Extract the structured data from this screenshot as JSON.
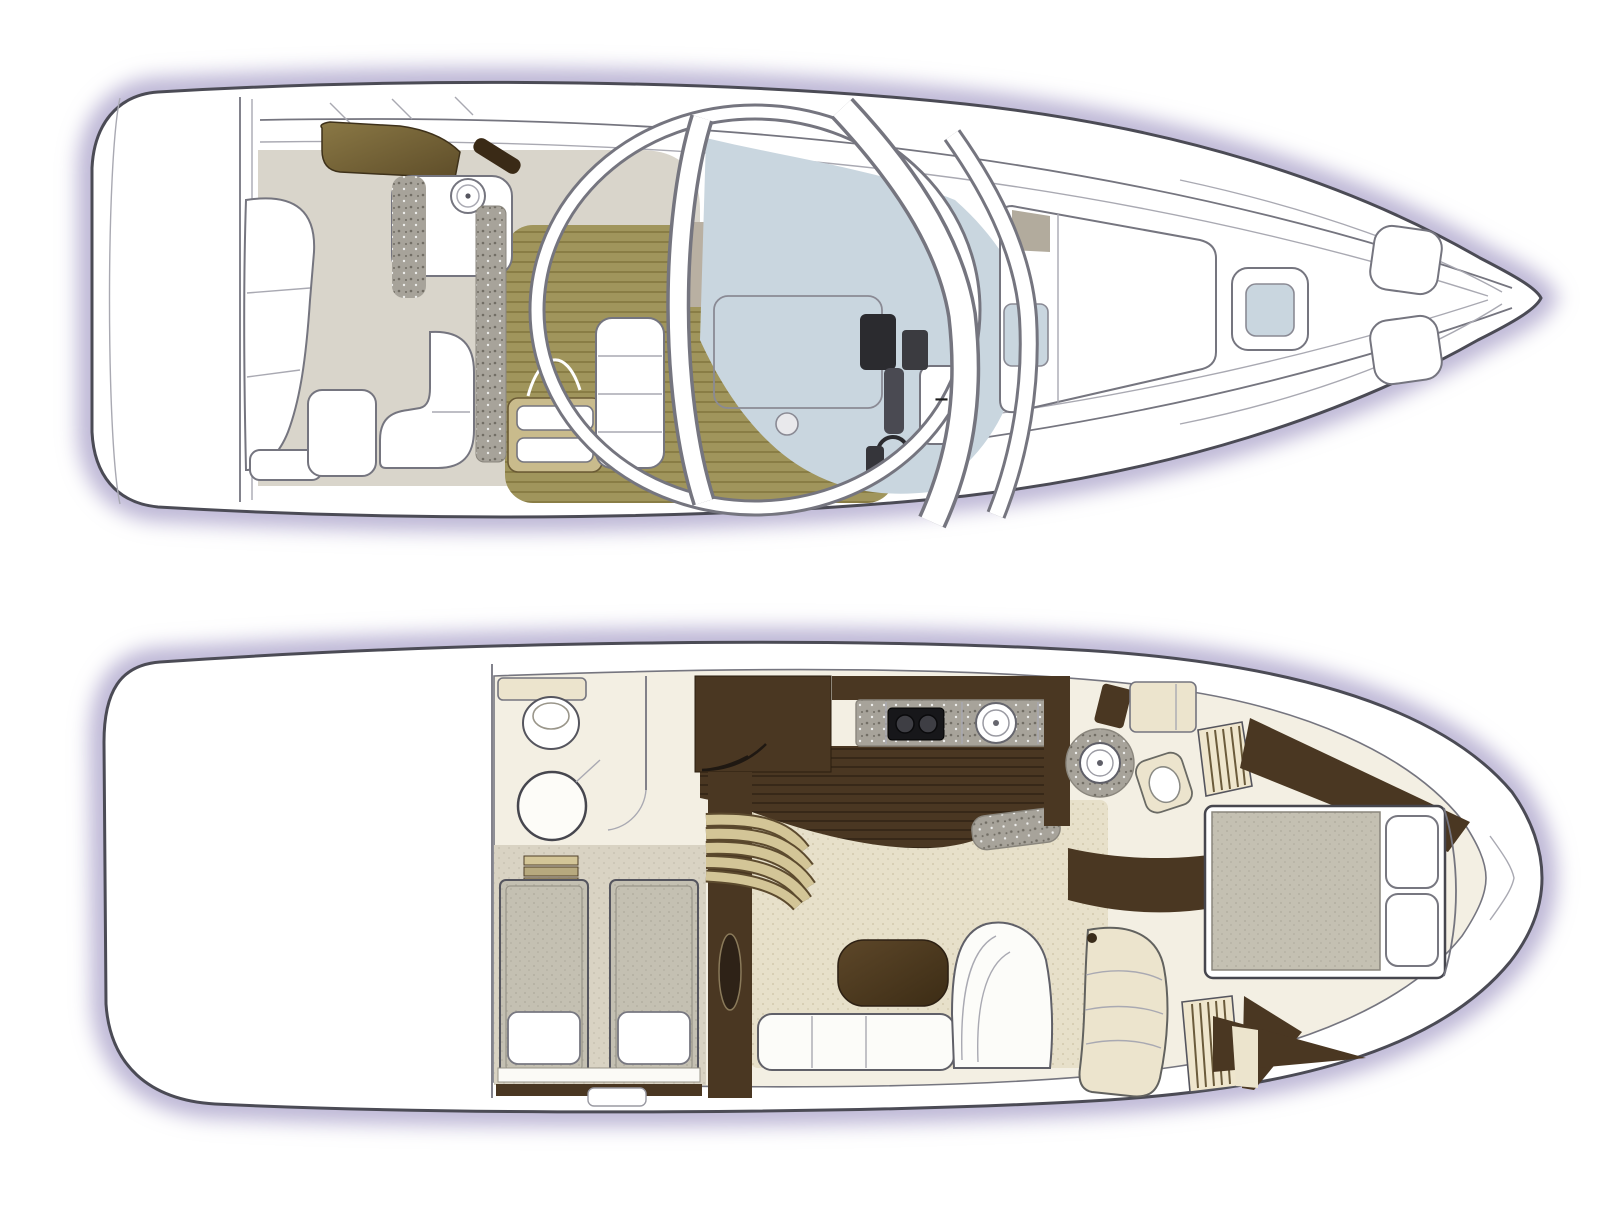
{
  "marks": {
    "dash": "–"
  },
  "palette": {
    "glow": "#a8a0c8",
    "outline": "#4b4b55",
    "line": "#75757f",
    "line_soft": "#a9a9b2",
    "cockpit_floor": "#d9d5cb",
    "teak": "#a0955c",
    "teak_stripe": "#83773f",
    "granite": "#a7a39a",
    "granite_dot": "#716d64",
    "glass": "#c9d6df",
    "taupe": "#b9b0a2",
    "wetbar_light": "#8a7845",
    "wetbar_dark": "#5e4d29",
    "darkwood": "#3a2a16",
    "tan": "#c9bb8c",
    "helm_dark": "#2b2b2f",
    "cream_floor": "#f3efe3",
    "cream": "#ece4cd",
    "carpet": "#e7e0ca",
    "carpet_dot": "#d2c9ad",
    "cabin_carpet": "#d9d3c3",
    "wood_dark": "#4a3722",
    "wood_line": "#2f2213",
    "mattress": "#c4c0b2",
    "mattress_dot": "#aeaa9c",
    "tread": "#d3c597",
    "tread_dark": "#5c4a2e",
    "sofa": "#fcfcf9",
    "pad_shadow": "#b2ab9d"
  }
}
